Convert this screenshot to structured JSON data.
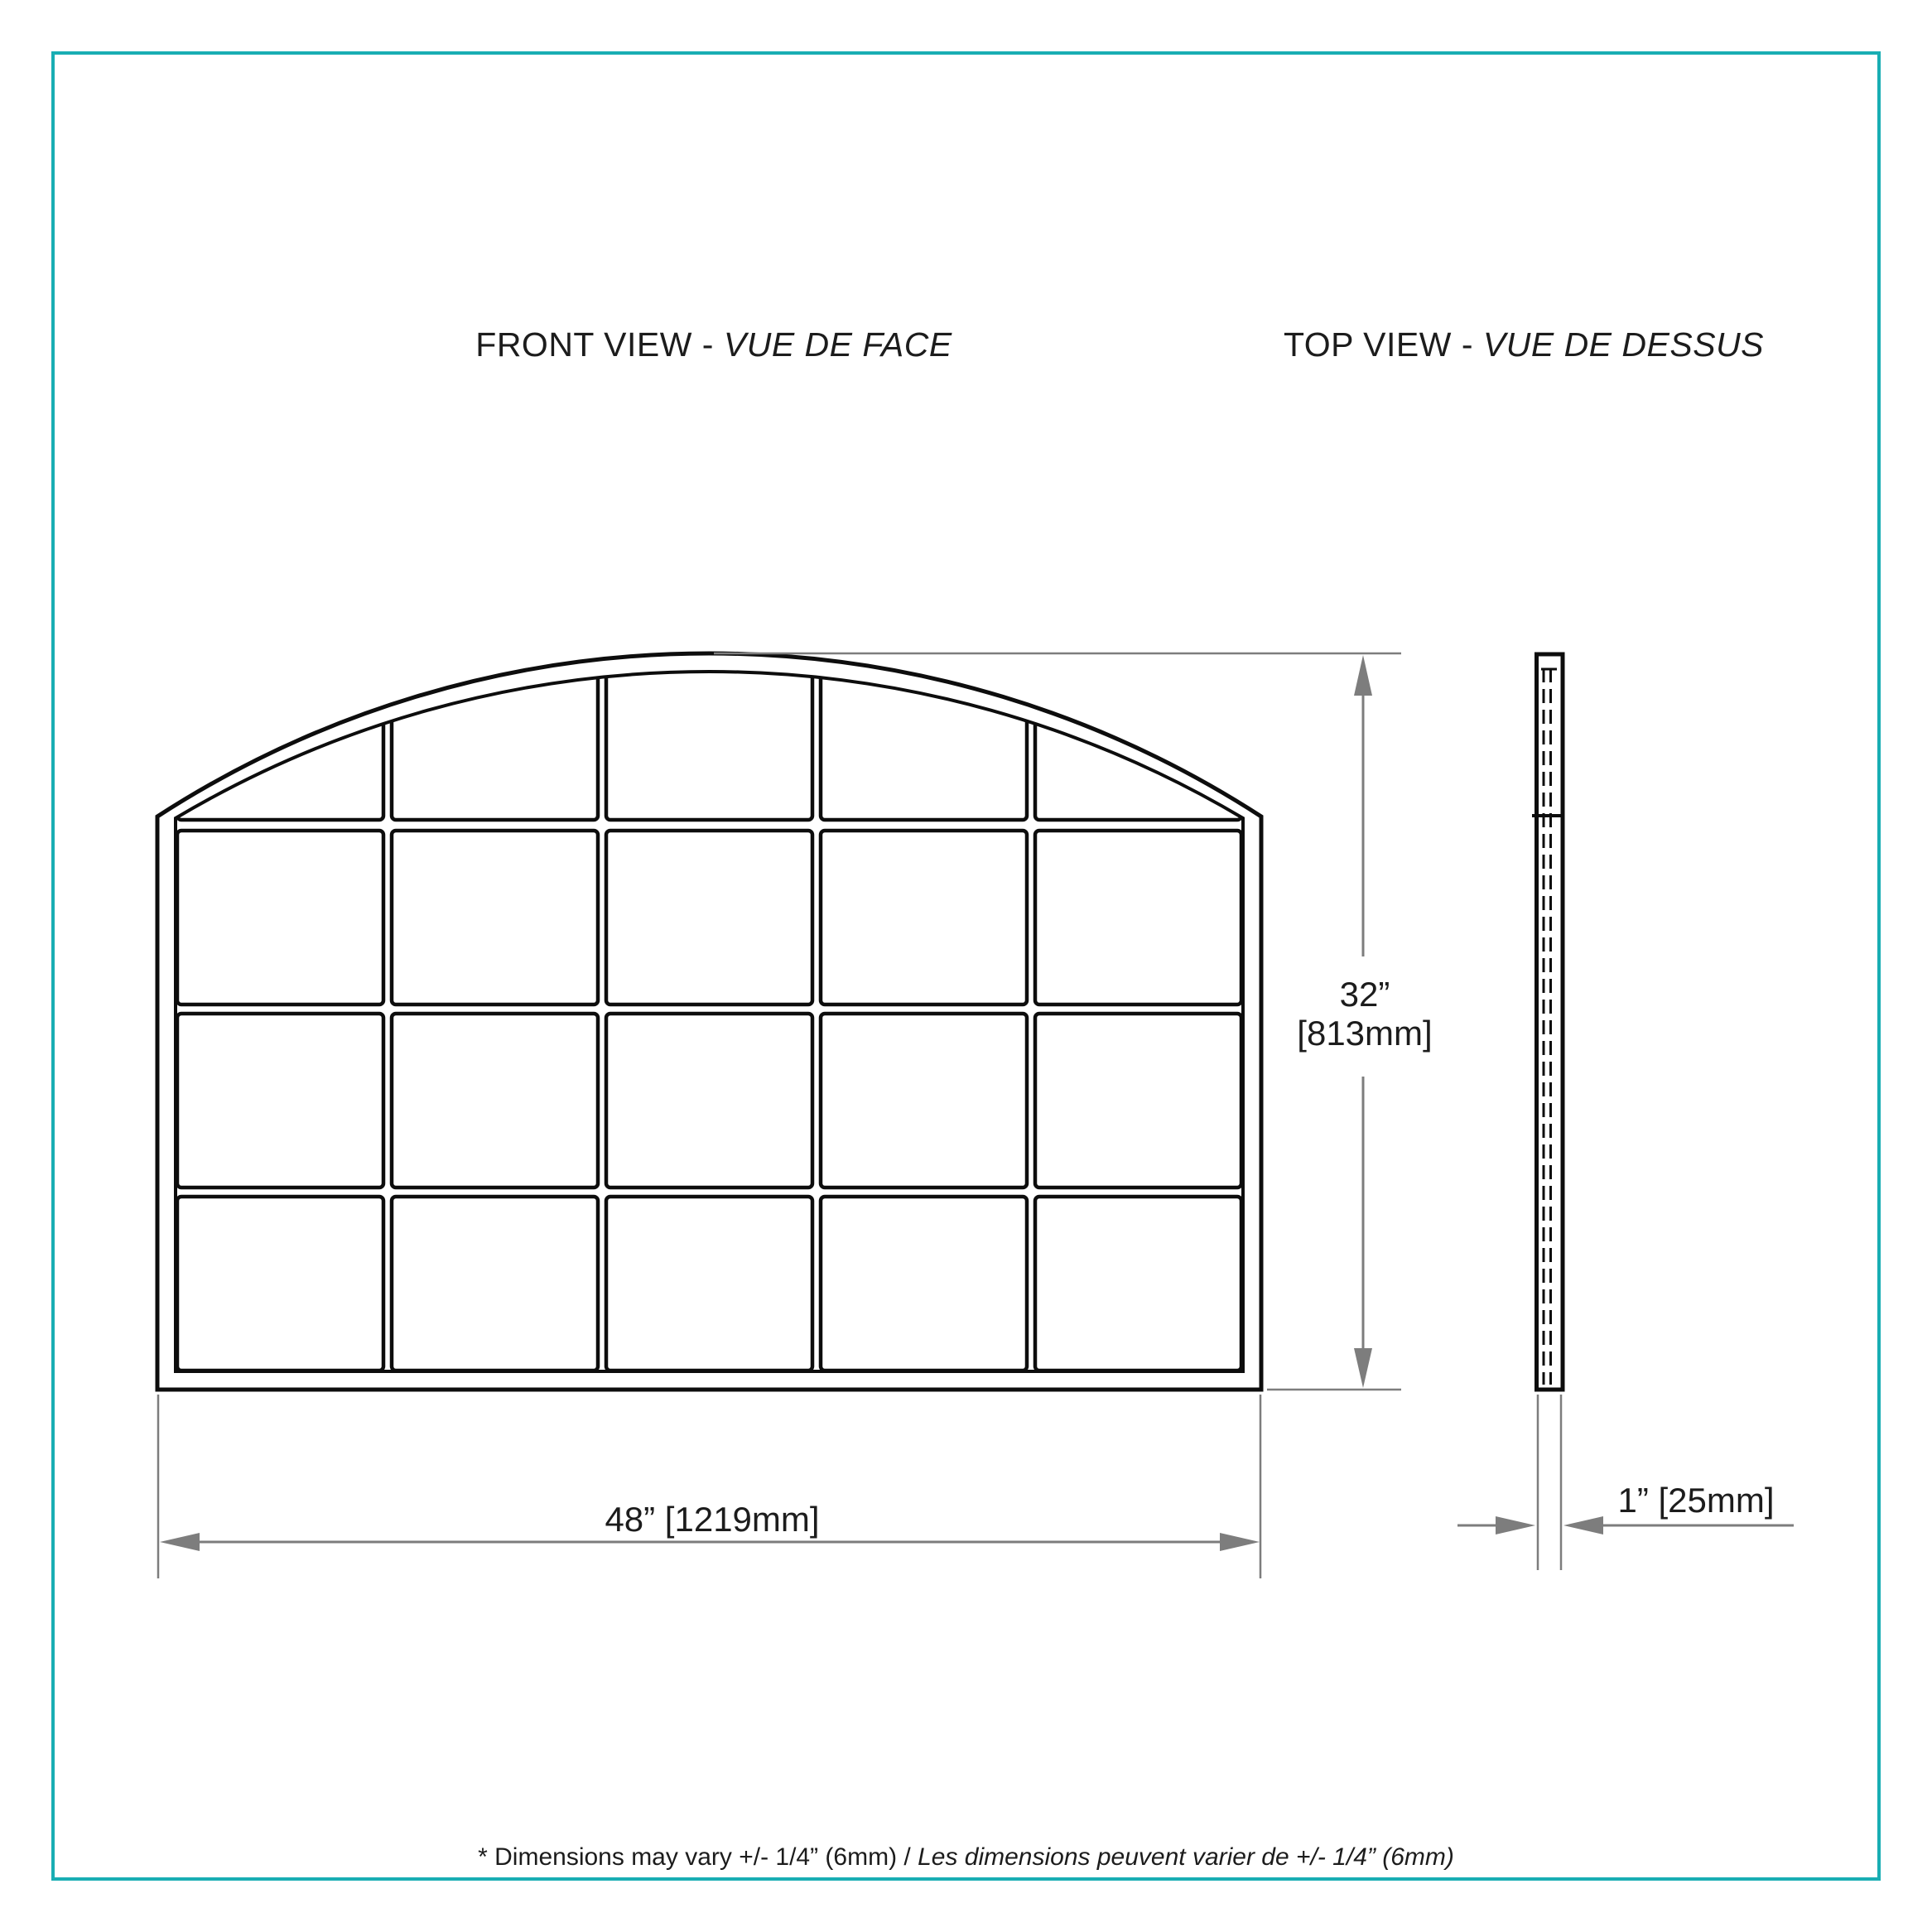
{
  "titles": {
    "front_view_prefix": "FRONT VIEW - ",
    "front_view_italic": "VUE DE FACE",
    "top_view_prefix": "TOP VIEW - ",
    "top_view_italic": "VUE DE DESSUS"
  },
  "front_view": {
    "grid": {
      "columns": 5,
      "rows": 4,
      "pane_count": 20,
      "shape": "arched-top"
    }
  },
  "dimensions": {
    "height": {
      "line1": "32”",
      "line2": "[813mm]"
    },
    "width": {
      "label": "48” [1219mm]"
    },
    "thickness": {
      "label": "1” [25mm]"
    }
  },
  "footnote": {
    "en": "* Dimensions may vary +/- 1/4” (6mm) / ",
    "fr": "Les dimensions peuvent varier de +/- 1/4” (6mm)"
  },
  "colors": {
    "border_teal": "#19aeb3",
    "drawing_line": "#0d0d0d",
    "dimension_gray": "#7d7d7d",
    "background": "#ffffff"
  }
}
